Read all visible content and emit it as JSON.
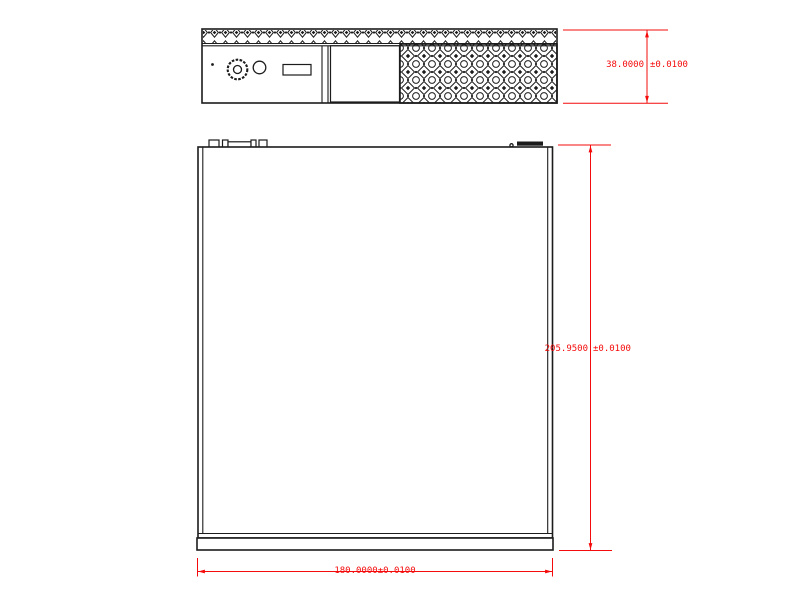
{
  "drawing": {
    "dimensions": {
      "front_height": {
        "value": "38.0000",
        "tolerance": "±0.0100"
      },
      "body_depth": {
        "value": "205.9500",
        "tolerance": "±0.0100"
      },
      "body_width": {
        "value": "180.0000",
        "tolerance": "±0.0100"
      }
    },
    "colors": {
      "ink": "#1c1c1c",
      "dimension": "#f40b0b",
      "background": "#ffffff"
    }
  }
}
